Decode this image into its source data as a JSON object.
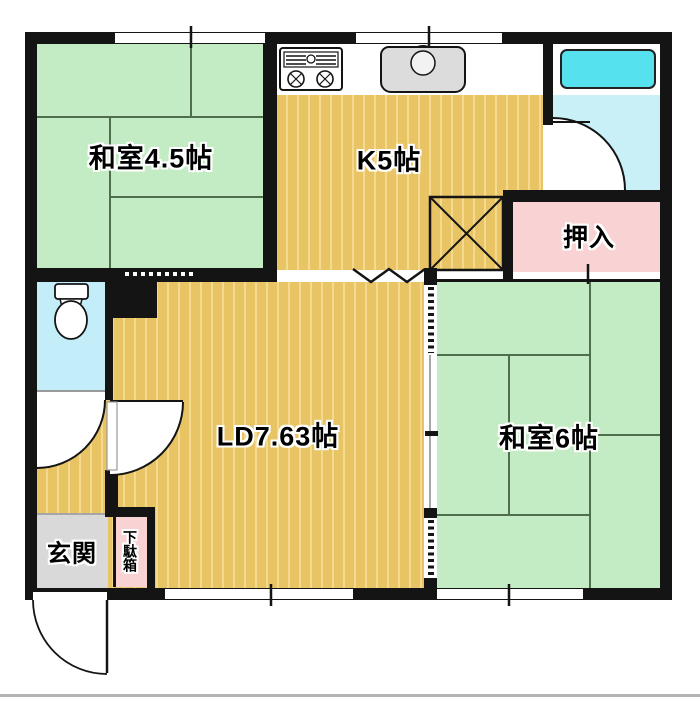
{
  "plan": {
    "type": "apartment-floor-plan",
    "rooms": {
      "washitsu45": {
        "label": "和室4.5帖"
      },
      "kitchen": {
        "label": "K5帖"
      },
      "living": {
        "label": "LD7.63帖"
      },
      "washitsu6": {
        "label": "和室6帖"
      },
      "oshiire": {
        "label": "押入"
      },
      "genkan": {
        "label": "玄関"
      },
      "getabako": {
        "label": "下駄箱"
      }
    },
    "fixtures": [
      "stove-icon",
      "sink-icon",
      "bathtub-icon",
      "toilet-icon",
      "refrigerator-space-x-box",
      "folding-door-zigzag",
      "sliding-door-dashes",
      "swing-door-arcs",
      "window-openings"
    ],
    "palette": {
      "wall": "#141414",
      "tatami_green": "#c4ecc4",
      "tatami_line": "#4e6e4e",
      "wood_floor": "#e9c464",
      "wood_stripe": "#f3da8e",
      "closet_pink": "#f9d3d3",
      "bath_floor": "#c9f0f7",
      "bathtub_cyan": "#55e2ee",
      "entry_tile_gray": "#d9d9d9",
      "sink_gray": "#dcdcdc"
    }
  }
}
